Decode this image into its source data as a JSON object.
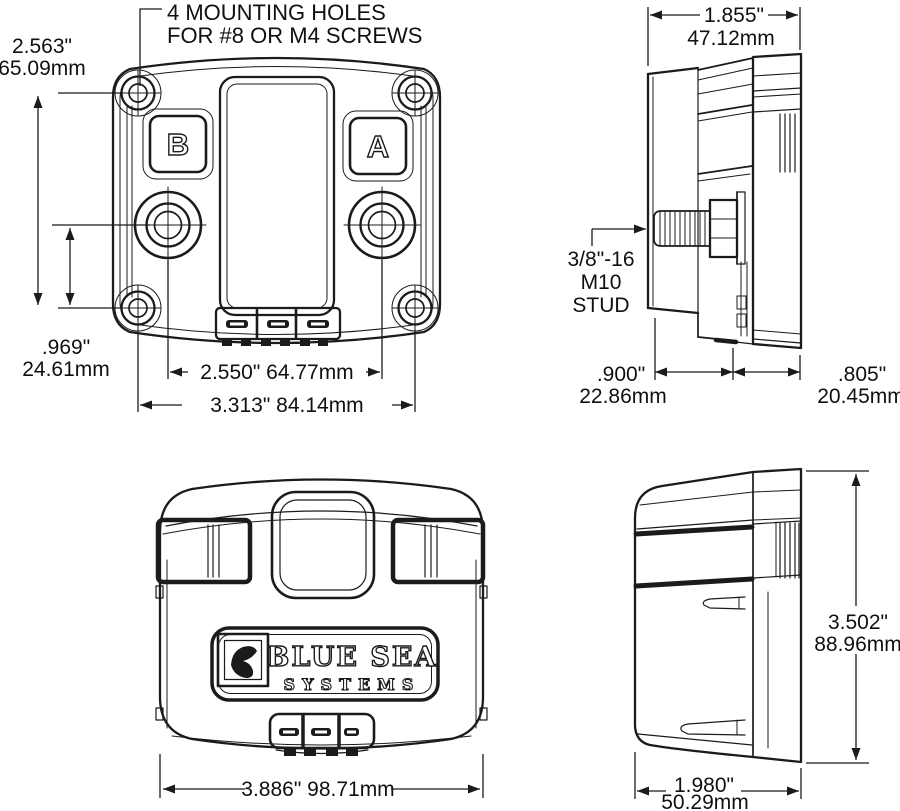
{
  "document": {
    "type": "technical-dimension-drawing",
    "background": "#ffffff",
    "line_color": "#1b1b1b"
  },
  "views": {
    "front": {
      "note_line1": "4 MOUNTING HOLES",
      "note_line2": "FOR #8 OR M4 SCREWS",
      "button_left_label": "B",
      "button_right_label": "A",
      "dim_hole_height_in": "2.563\"",
      "dim_hole_height_mm": "65.09mm",
      "dim_stud_to_hole_in": ".969\"",
      "dim_stud_to_hole_mm": "24.61mm",
      "dim_stud_spacing": "2.550\" 64.77mm",
      "dim_hole_spacing": "3.313\" 84.14mm"
    },
    "side": {
      "dim_depth_in": "1.855\"",
      "dim_depth_mm": "47.12mm",
      "stud_label_line1": "3/8\"-16",
      "stud_label_line2": "M10",
      "stud_label_line3": "STUD",
      "dim_front_depth_in": ".900\"",
      "dim_front_depth_mm": "22.86mm",
      "dim_rear_depth_in": ".805\"",
      "dim_rear_depth_mm": "20.45mm"
    },
    "cover_front": {
      "logo_line1": "BLUE SEA",
      "logo_line2": "SYSTEMS",
      "dim_width": "3.886\" 98.71mm"
    },
    "cover_side": {
      "dim_height_in": "3.502\"",
      "dim_height_mm": "88.96mm",
      "dim_depth_in": "1.980\"",
      "dim_depth_mm": "50.29mm"
    }
  }
}
